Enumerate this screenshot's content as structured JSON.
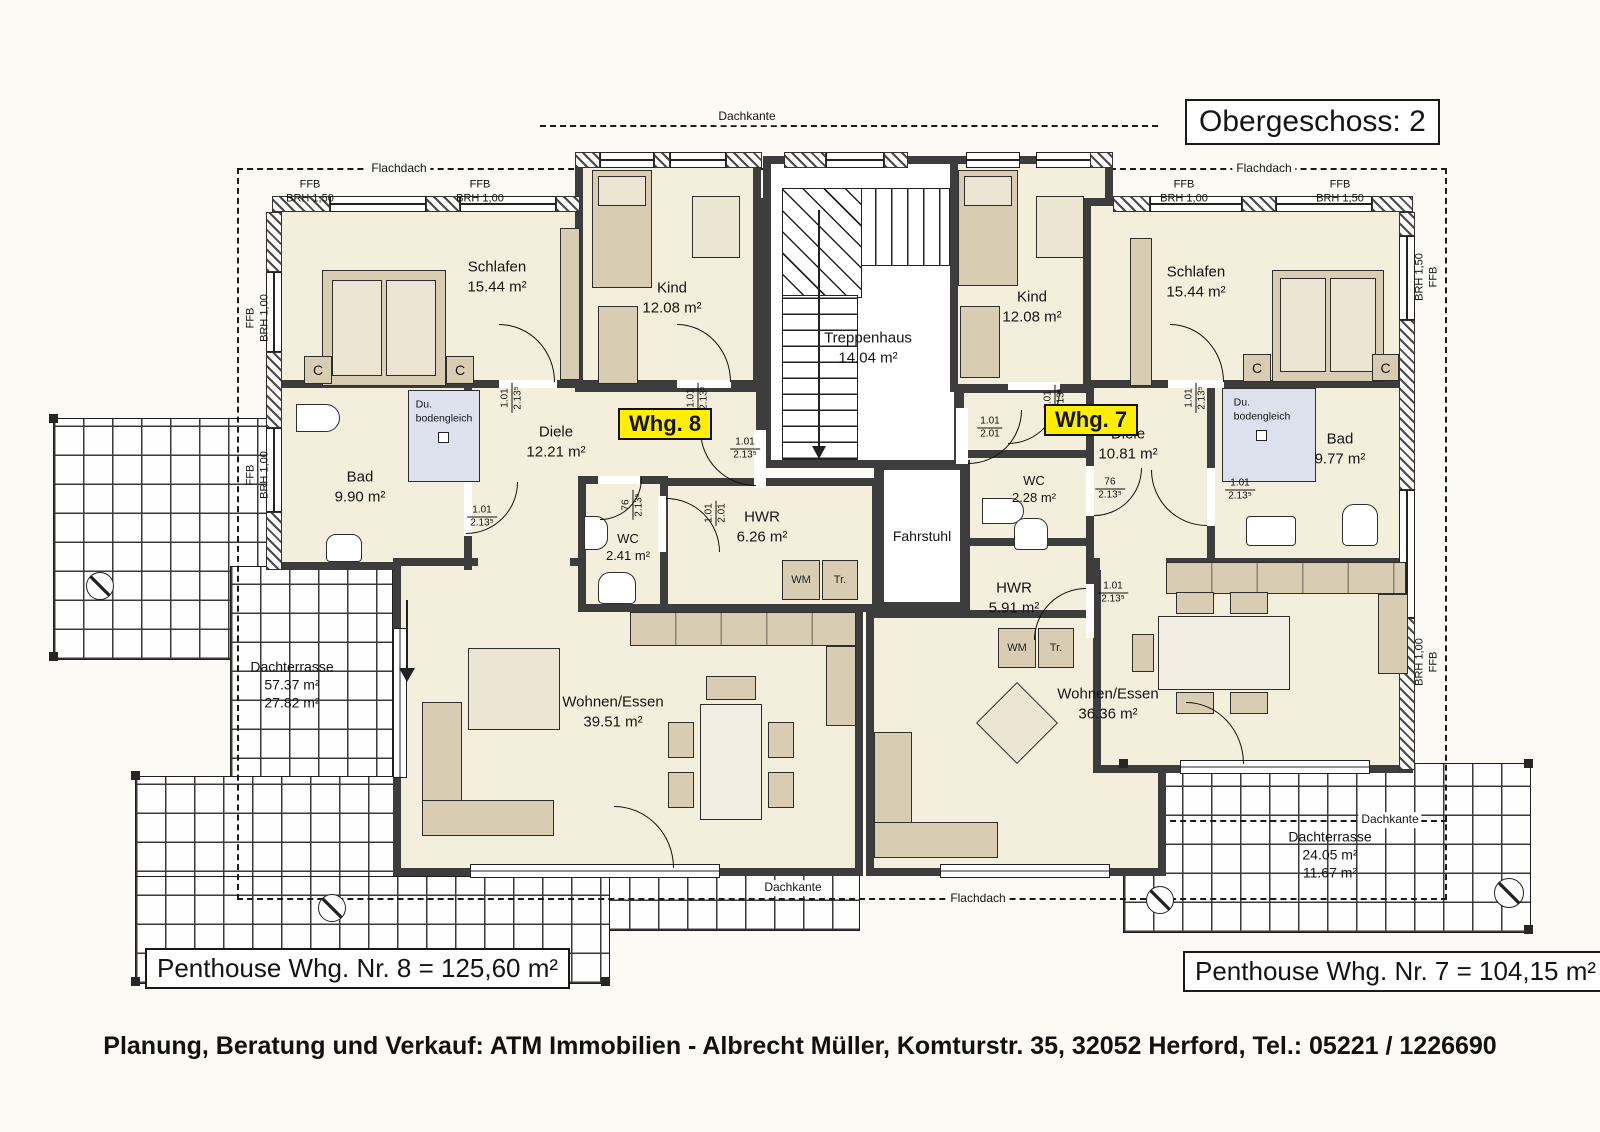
{
  "title": "Obergeschoss: 2",
  "apartments": {
    "whg8_badge": "Whg. 8",
    "whg7_badge": "Whg. 7",
    "penthouse8": "Penthouse Whg. Nr. 8 = 125,60 m²",
    "penthouse7": "Penthouse Whg. Nr. 7 = 104,15 m²"
  },
  "rooms": {
    "schlafen8": {
      "name": "Schlafen",
      "area": "15.44 m²"
    },
    "kind8": {
      "name": "Kind",
      "area": "12.08 m²"
    },
    "treppenhaus": {
      "name": "Treppenhaus",
      "area": "14.04 m²"
    },
    "kind7": {
      "name": "Kind",
      "area": "12.08 m²"
    },
    "schlafen7": {
      "name": "Schlafen",
      "area": "15.44 m²"
    },
    "bad8": {
      "name": "Bad",
      "area": "9.90 m²"
    },
    "diele8": {
      "name": "Diele",
      "area": "12.21 m²"
    },
    "wc8": {
      "name": "WC",
      "area": "2.41 m²"
    },
    "hwr8": {
      "name": "HWR",
      "area": "6.26 m²"
    },
    "fahrstuhl": {
      "name": "Fahrstuhl"
    },
    "wc7": {
      "name": "WC",
      "area": "2.28 m²"
    },
    "diele7": {
      "name": "Diele",
      "area": "10.81 m²"
    },
    "bad7": {
      "name": "Bad",
      "area": "9.77 m²"
    },
    "hwr7": {
      "name": "HWR",
      "area": "5.91 m²"
    },
    "wohnen8": {
      "name": "Wohnen/Essen",
      "area": "39.51 m²"
    },
    "wohnen7": {
      "name": "Wohnen/Essen",
      "area": "36.36 m²"
    },
    "terrasse8": {
      "name": "Dachterrasse",
      "area1": "57.37 m²",
      "area2": "27.82 m²"
    },
    "terrasse7": {
      "name": "Dachterrasse",
      "area1": "24.05 m²",
      "area2": "11.67 m²"
    }
  },
  "annotations": {
    "dachkante": "Dachkante",
    "flachdach": "Flachdach",
    "du_bodengleich": "Du.\nbodengleich",
    "wm": "WM",
    "tr": "Tr.",
    "c_marker": "C",
    "ffb_brh150": "FFB\nBRH 1,50",
    "ffb_brh100": "FFB\nBRH 1,00",
    "brh150_ffb": "BRH 1,50\nFFB",
    "brh100_ffb": "BRH 1,00\nFFB"
  },
  "dims": {
    "w101": "1.01",
    "h2135": "2.13⁵",
    "w76": "76",
    "h201": "2.01"
  },
  "footer": "Planung, Beratung und Verkauf: ATM Immobilien - Albrecht Müller, Komturstr. 35, 32052 Herford, Tel.: 05221 / 1226690"
}
